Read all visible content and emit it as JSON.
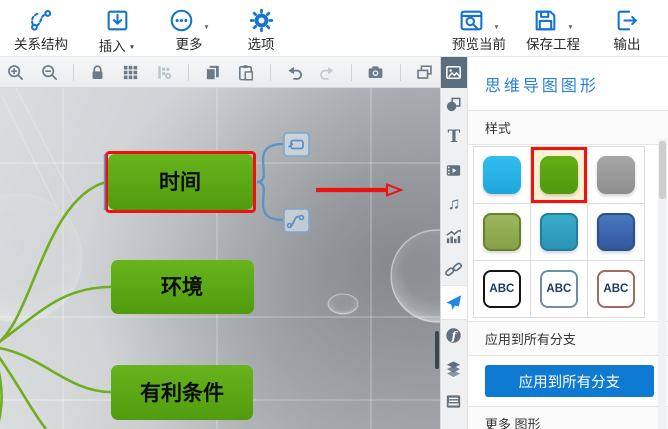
{
  "colors": {
    "accent_blue": "#1374d0",
    "button_blue": "#0f7ad1",
    "node_green": "#58a512",
    "selection_red": "#ee1211",
    "branch_green": "#6fae1e",
    "connector_blue": "#6b9bcd"
  },
  "toolbar_top": {
    "items": [
      {
        "label": "关系结构",
        "icon": "relation-structure-icon",
        "caret": false
      },
      {
        "label": "插入",
        "icon": "insert-icon",
        "caret": true
      },
      {
        "label": "更多",
        "icon": "more-icon",
        "caret": true
      },
      {
        "label": "选项",
        "icon": "options-gear-icon",
        "caret": false
      },
      {
        "label": "预览当前",
        "icon": "preview-icon",
        "caret": true
      },
      {
        "label": "保存工程",
        "icon": "save-floppy-icon",
        "caret": true
      },
      {
        "label": "输出",
        "icon": "export-icon",
        "caret": false
      }
    ]
  },
  "toolbar_secondary": {
    "icons": [
      "zoom-in",
      "zoom-out",
      "lock",
      "grid",
      "table-settings-disabled",
      "copy",
      "paste",
      "undo",
      "redo-disabled",
      "camera",
      "arrange-windows",
      "background-image"
    ]
  },
  "side_strip": {
    "icons": [
      "image",
      "shape",
      "text",
      "video",
      "music",
      "chart",
      "link",
      "clipart-plane",
      "flash",
      "layers",
      "card-file"
    ],
    "active": "clipart-plane"
  },
  "icons": {
    "caret_glyph": "▼",
    "text_glyph": "T",
    "music_glyph": "♫",
    "flash_glyph": "f"
  },
  "panel": {
    "title": "思维导图图形",
    "style_section": "样式",
    "apply_section": "应用到所有分支",
    "apply_button": "应用到所有分支",
    "more_section": "更多 图形",
    "abc": "ABC",
    "swatch_colors": [
      "#29b5e8",
      "#57a413",
      "#9b9b9b",
      "#93ad52",
      "#2e9fc0",
      "#3b6cb3"
    ],
    "abc_border_colors": [
      "#141414",
      "#6d8cab",
      "#a2695f"
    ],
    "selected_swatch_index": 1
  },
  "canvas": {
    "nodes": [
      {
        "label": "时间",
        "selected": true
      },
      {
        "label": "环境",
        "selected": false
      },
      {
        "label": "有利条件",
        "selected": false
      }
    ]
  }
}
